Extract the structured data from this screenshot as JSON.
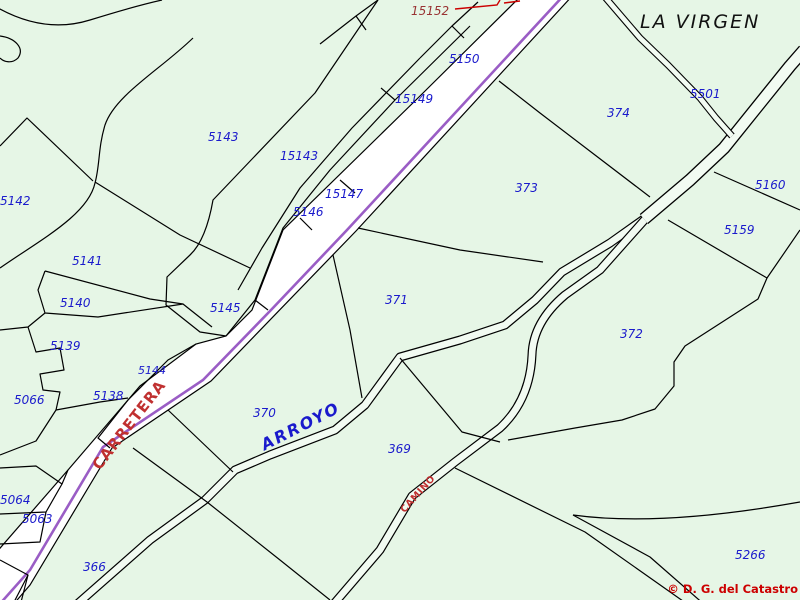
{
  "map": {
    "place_name": "LA VIRGEN",
    "road_label": "CARRETERA",
    "stream_label": "ARROYO",
    "path_label": "CAMINO",
    "copyright": "© D. G. del Catastro",
    "special_parcel": "15152",
    "colors": {
      "background": "#e6f6e6",
      "boundary_line": "#000000",
      "road_centerline_purple": "#9a5dc5",
      "road_fill": "#ffffff",
      "parcel_number_blue": "#1a1acc",
      "special_parcel_red": "#993333",
      "feature_label_red": "#c03030",
      "copyright_red": "#cc0000",
      "place_name_black": "#111111"
    },
    "parcel_labels": [
      "5143",
      "15143",
      "15147",
      "5146",
      "5145",
      "5144",
      "5142",
      "5141",
      "5140",
      "5139",
      "5138",
      "5066",
      "5064",
      "5063",
      "366",
      "15149",
      "5150",
      "374",
      "373",
      "371",
      "372",
      "370",
      "369",
      "5160",
      "5159",
      "5501",
      "5266"
    ]
  }
}
